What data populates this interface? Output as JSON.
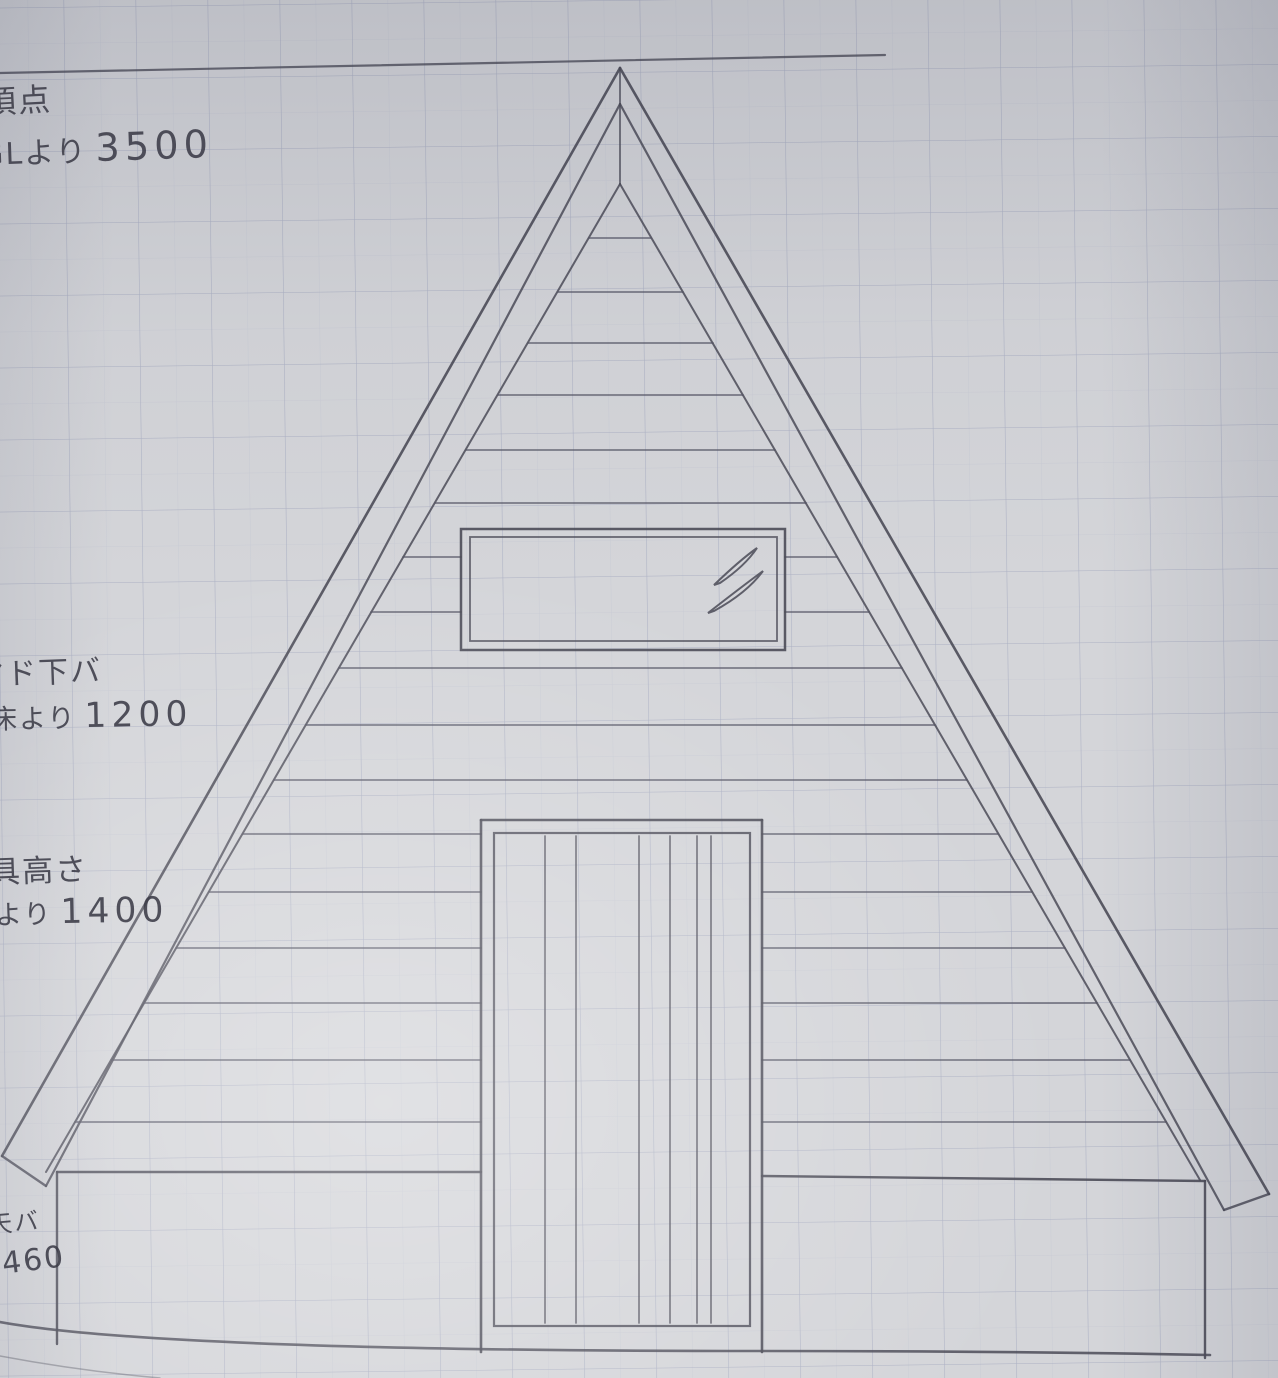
{
  "document": {
    "kind": "hand-drawn architectural sketch",
    "subject": "A-frame cabin front elevation, pencil on graph paper"
  },
  "annotations": {
    "apex": {
      "label": "頂点",
      "dim_prefix": "GLより",
      "dim_value": "3500"
    },
    "window_sill": {
      "label": "マド下バ",
      "dim_prefix": "床より",
      "dim_value": "1200"
    },
    "fixture_height": {
      "label": "建具高さ",
      "dim_prefix": "床より",
      "dim_value": "1400"
    },
    "deck_top": {
      "label": "天バ",
      "dim_prefix": "",
      "dim_value": "460"
    }
  },
  "colors": {
    "paper": "#d4d5d9",
    "grid_line": "#8791af",
    "pencil": "#4b4b57",
    "handwriting": "#3c3c48"
  }
}
